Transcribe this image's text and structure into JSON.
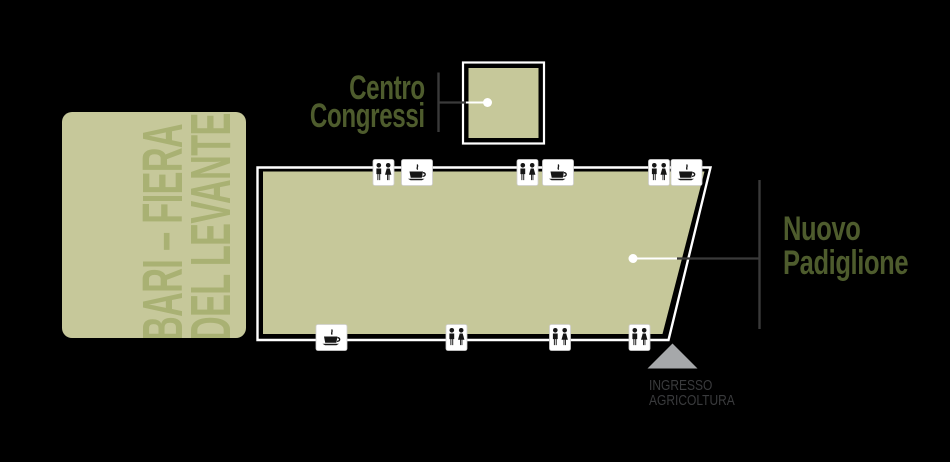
{
  "canvas": {
    "background": "#000000",
    "width": 950,
    "height": 462
  },
  "venue_block": {
    "line1": "BARI – FIERA",
    "line2": "DEL LEVANTE",
    "fill": "#c6c89a",
    "text_color": "#a9b173"
  },
  "buildings": {
    "centro_congressi": {
      "label_line1": "Centro",
      "label_line2": "Congressi",
      "fill": "#c6c89a",
      "label_color": "#4e5c2d"
    },
    "nuovo_padiglione": {
      "label_line1": "Nuovo",
      "label_line2": "Padiglione",
      "fill": "#c6c89a",
      "label_color": "#4e5c2d"
    }
  },
  "entrance": {
    "line1": "INGRESSO",
    "line2": "AGRICOLTURA",
    "text_color": "#3a3b3d",
    "arrow_color": "#a6a8aa"
  },
  "connector_color": "#3a3a3a",
  "outline_color": "#ffffff",
  "facility_icons": {
    "legend": {
      "restroom": "restroom-icon",
      "bar": "coffee-cup-icon"
    },
    "placements": [
      {
        "type": "restroom",
        "x": 383.5,
        "y": 172.5
      },
      {
        "type": "bar",
        "x": 417,
        "y": 172.5
      },
      {
        "type": "restroom",
        "x": 527.5,
        "y": 172.5
      },
      {
        "type": "bar",
        "x": 558,
        "y": 172.5
      },
      {
        "type": "restroom",
        "x": 659,
        "y": 172.5
      },
      {
        "type": "bar",
        "x": 686.5,
        "y": 172.5
      },
      {
        "type": "bar",
        "x": 331.5,
        "y": 337.5
      },
      {
        "type": "restroom",
        "x": 456.5,
        "y": 337.5
      },
      {
        "type": "restroom",
        "x": 560,
        "y": 337.5
      },
      {
        "type": "restroom",
        "x": 639.5,
        "y": 337.5
      }
    ]
  }
}
